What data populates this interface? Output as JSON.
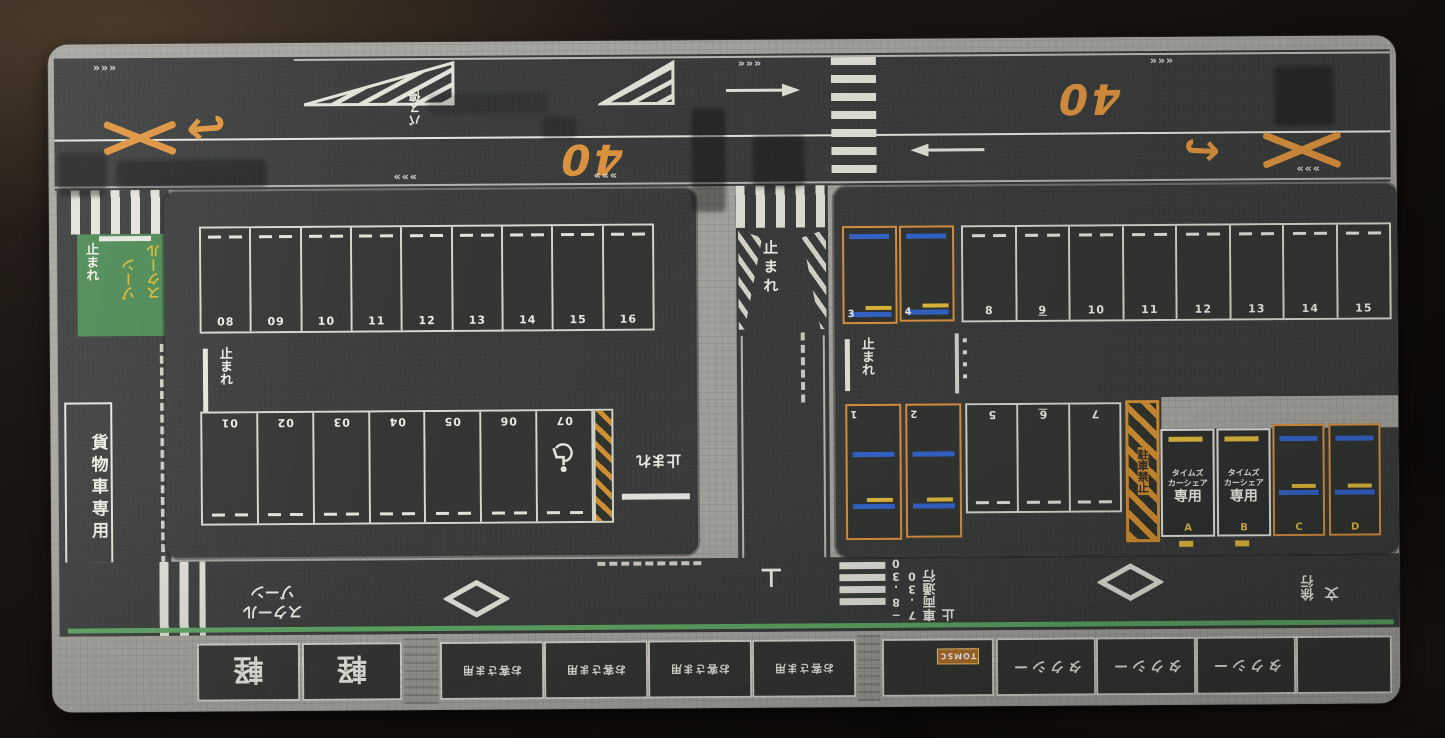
{
  "scene": {
    "description": "Photograph of a Japanese miniature parking-lot play mat lying on a dark table"
  },
  "colors": {
    "table": "#16110e",
    "sidewalk": "#a7a6a0",
    "asphalt": "#3a3d3b",
    "marking_white": "#e6e6df",
    "marking_orange": "#dd9440",
    "school_zone_green": "#4c8a54",
    "edge_line_green": "#5fa766",
    "wheel_stop_blue": "#3566cc",
    "wheel_stop_yellow": "#e3bb3f",
    "hatch_orange": "#d69234"
  },
  "common": {
    "stop": "止まれ",
    "speed_limit": "40"
  },
  "top_road": {
    "bus_stop": "バス停",
    "chevrons_right": "»»»",
    "chevrons_left": "«««",
    "uturn_left": "↩",
    "uturn_right": "↪"
  },
  "left_lane": {
    "school_zone_col1": "ゾーン",
    "school_zone_col2": "スクール",
    "cargo_only": "貨物車専用"
  },
  "left_lot": {
    "top_row": [
      "08",
      "09",
      "10",
      "11",
      "12",
      "13",
      "14",
      "15",
      "16"
    ],
    "bottom_row": [
      "01",
      "02",
      "03",
      "04",
      "05",
      "06",
      "07"
    ]
  },
  "right_lot": {
    "ev_top": [
      "3",
      "4"
    ],
    "top_row": [
      "8",
      "9",
      "10",
      "11",
      "12",
      "13",
      "14",
      "15"
    ],
    "ev_bottom": [
      "1",
      "2"
    ],
    "bottom_row": [
      "5",
      "6",
      "7"
    ],
    "no_parking": "駐車禁止",
    "carshare_line1": "タイムズ",
    "carshare_line2": "カーシェア",
    "carshare_line3": "専用",
    "carshare_spaces": [
      "A",
      "B"
    ],
    "reserved_spaces": [
      "C",
      "D"
    ]
  },
  "bottom_road": {
    "school_zone_line1": "スクール",
    "school_zone_line2": "ゾーン",
    "restriction": "車両通行止",
    "restriction_time1": "7.30",
    "restriction_time2": "−8.30",
    "t_mark": "⊥",
    "school_mark": "文",
    "slow": "徐行"
  },
  "bottom_strip": {
    "kei": "軽",
    "customer": "お客さま用",
    "logo": "TOMSC",
    "taxi": "タクシー"
  }
}
